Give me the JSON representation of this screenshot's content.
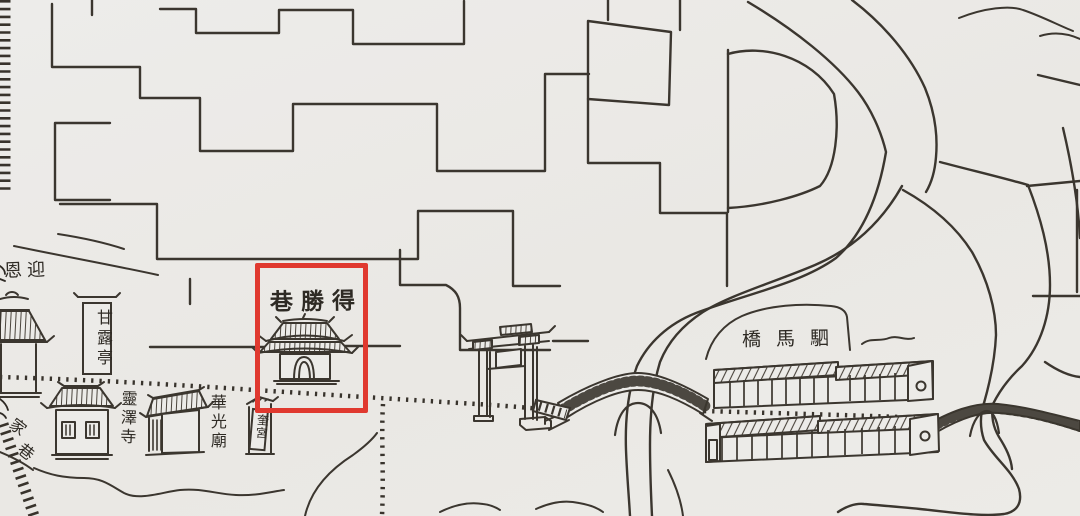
{
  "map": {
    "description_labels": {
      "yingen": "恩迎",
      "ganlu_pavilion": "甘露亭",
      "desheng_lane": "巷勝得",
      "lingze_temple": "靈澤寺",
      "huaguang_temple": "華光廟",
      "kui_palace": "奎宮",
      "sima_bridge": "橋馬駟",
      "jia_lane_chars": [
        "家",
        "巷"
      ]
    },
    "highlight_color": "#e0392f",
    "ink_color": "#3b362f",
    "paper_color": "#ecebe8",
    "highlight_box": {
      "x": 255,
      "y": 263,
      "width": 113,
      "height": 150
    }
  }
}
